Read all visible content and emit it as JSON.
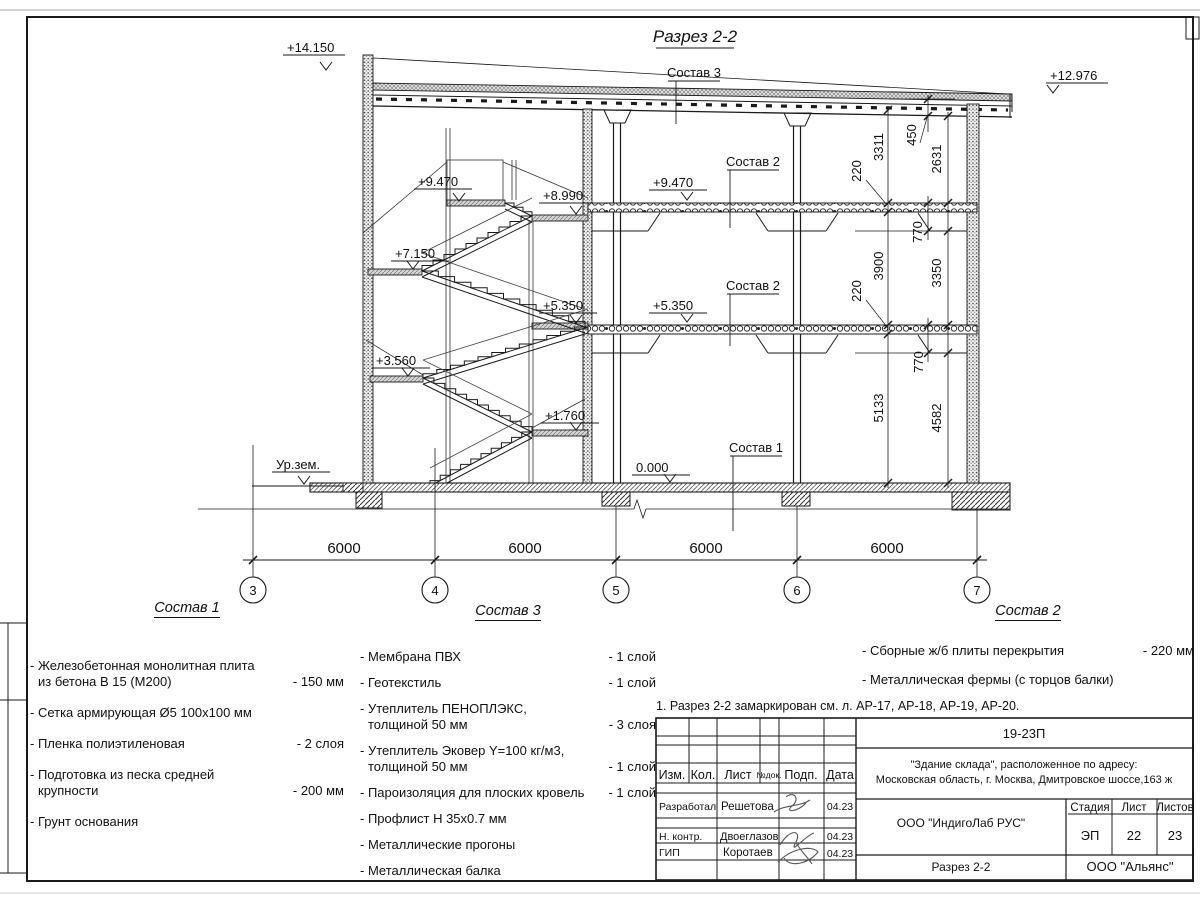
{
  "fig": {
    "title": "Разрез 2-2"
  },
  "elev": {
    "e14150": "+14.150",
    "e12976": "+12.976",
    "e9470s": "+9.470",
    "e8990": "+8.990",
    "e9470f": "+9.470",
    "e7150": "+7.150",
    "e5350s": "+5.350",
    "e5350f": "+5.350",
    "e3560": "+3.560",
    "e1760": "+1.760",
    "e0": "0.000",
    "ground": "Ур.зем."
  },
  "leaders": {
    "s3": "Состав 3",
    "s2a": "Состав 2",
    "s2b": "Состав 2",
    "s1": "Состав 1"
  },
  "dims": {
    "spans": [
      "6000",
      "6000",
      "6000",
      "6000"
    ],
    "grids": [
      "3",
      "4",
      "5",
      "6",
      "7"
    ],
    "right": {
      "d450": "450",
      "d2631": "2631",
      "d3311": "3311",
      "d220a": "220",
      "d220b": "220",
      "d3900": "3900",
      "d770a": "770",
      "d770b": "770",
      "d3350": "3350",
      "d5133": "5133",
      "d4582": "4582"
    }
  },
  "s1": {
    "title": "Состав 1",
    "items": [
      {
        "l1": "- Железобетонная  монолитная плита",
        "l2": "из бетона В 15 (М200)",
        "val": "- 150 мм"
      },
      {
        "l1": "- Сетка армирующая Ø5 100x100 мм",
        "l2": "",
        "val": ""
      },
      {
        "l1": "- Пленка полиэтиленовая",
        "l2": "",
        "val": "-  2 слоя"
      },
      {
        "l1": "- Подготовка из песка средней",
        "l2": "крупности",
        "val": "- 200 мм"
      },
      {
        "l1": "- Грунт основания",
        "l2": "",
        "val": ""
      }
    ]
  },
  "s3": {
    "title": "Состав 3",
    "items": [
      {
        "l1": "- Мембрана ПВХ",
        "l2": "",
        "val": "- 1 слой"
      },
      {
        "l1": "- Геотекстиль",
        "l2": "",
        "val": "- 1 слой"
      },
      {
        "l1": "- Утеплитель ПЕНОПЛЭКС,",
        "l2": "толщиной 50 мм",
        "val": "- 3 слоя"
      },
      {
        "l1": "- Утеплитель Эковер Y=100 кг/м3,",
        "l2": "толщиной 50 мм",
        "val": "- 1 слой"
      },
      {
        "l1": "- Пароизоляция для плоских кровель",
        "l2": "",
        "val": "- 1 слой"
      },
      {
        "l1": "- Профлист Н 35x0.7 мм",
        "l2": "",
        "val": ""
      },
      {
        "l1": "- Металлические прогоны",
        "l2": "",
        "val": ""
      },
      {
        "l1": "- Металлическая балка",
        "l2": "",
        "val": ""
      }
    ]
  },
  "s2": {
    "title": "Состав 2",
    "items": [
      {
        "l1": "- Сборные ж/б плиты перекрытия",
        "l2": "",
        "val": "- 220 мм"
      },
      {
        "l1": "- Металлическая фермы (с торцов балки)",
        "l2": "",
        "val": ""
      }
    ]
  },
  "note": "1. Разрез 2-2 замаркирован см. л. АР-17, АР-18, АР-19, АР-20.",
  "tb": {
    "doc_number": "19-23П",
    "project_line1": "\"Здание склада\", расположенное по адресу:",
    "project_line2": "Московская область, г. Москва, Дмитровское шоссе,163 ж",
    "company": "ООО \"ИндигоЛаб РУС\"",
    "sheet_title": "Разрез 2-2",
    "org2": "ООО \"Альянс\"",
    "stage_label": "Стадия",
    "sheet_label": "Лист",
    "sheets_label": "Листов",
    "stage": "ЭП",
    "sheet": "22",
    "sheets": "23",
    "col_izm": "Изм.",
    "col_kol": "Кол.",
    "col_list": "Лист",
    "col_ndok": "№док.",
    "col_podp": "Подп.",
    "col_data": "Дата",
    "row1_role": "Разработал",
    "row1_name": "Решетова",
    "row1_date": "04.23",
    "row2_role": "Н. контр.",
    "row2_name": "Двоеглазов",
    "row2_date": "04.23",
    "row3_role": "ГИП",
    "row3_name": "Коротаев",
    "row3_date": "04.23"
  }
}
